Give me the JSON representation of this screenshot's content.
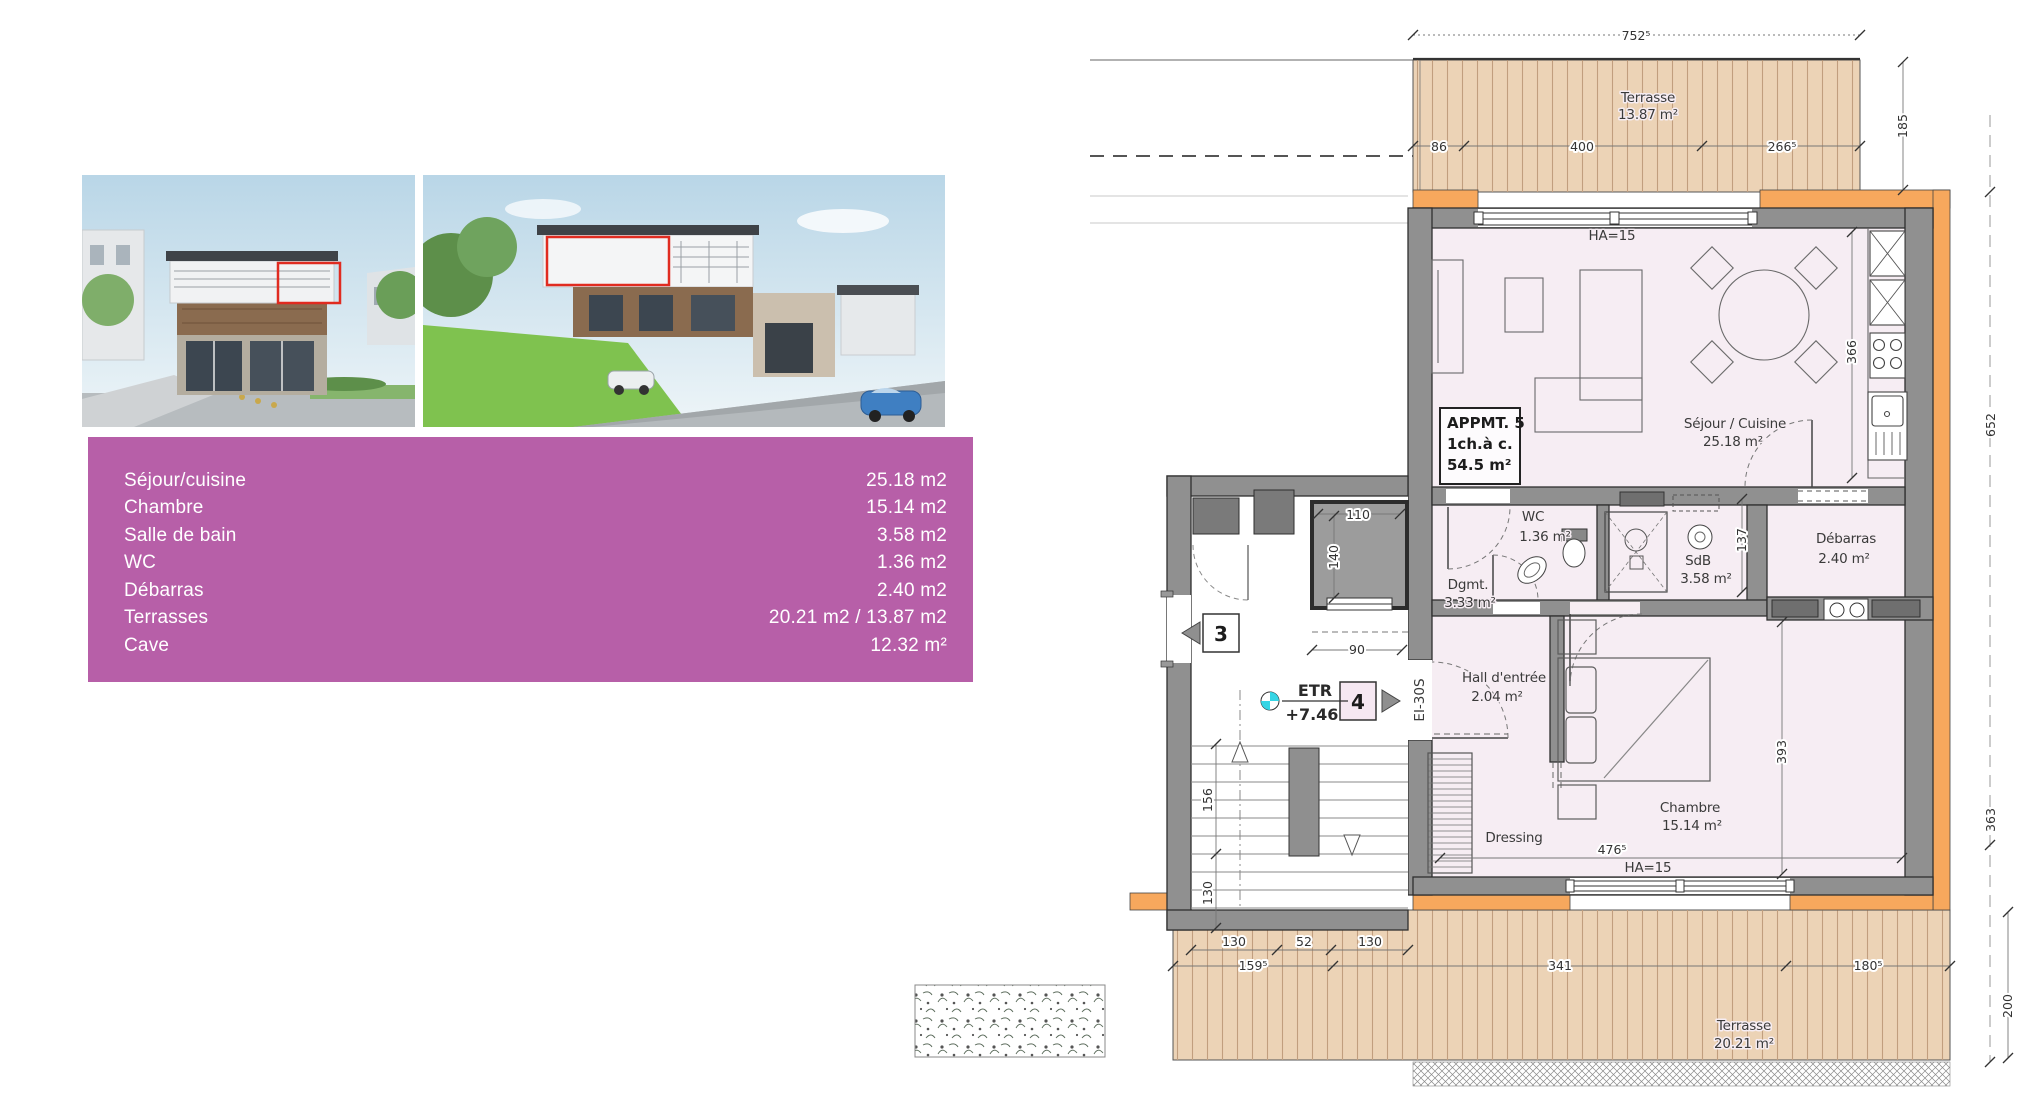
{
  "colors": {
    "accent_magenta": "#b75fa8",
    "highlight_red": "#e02b20",
    "insulation_orange": "#f7a85d",
    "deck_wood": "#ecd3b6",
    "interior_pink": "#f6edf3",
    "wall_gray": "#909090",
    "etr_cyan": "#35d5e5"
  },
  "table": {
    "rows": [
      {
        "label": "Séjour/cuisine",
        "value": "25.18 m2"
      },
      {
        "label": "Chambre",
        "value": "15.14 m2"
      },
      {
        "label": "Salle de bain",
        "value": "3.58 m2"
      },
      {
        "label": "WC",
        "value": "1.36 m2"
      },
      {
        "label": "Débarras",
        "value": "2.40 m2"
      },
      {
        "label": "Terrasses",
        "value": "20.21 m2 / 13.87 m2"
      },
      {
        "label": "Cave",
        "value": "12.32 m²"
      }
    ]
  },
  "plan": {
    "apartment_box": {
      "line1": "APPMT. 5",
      "line2": "1ch.à c.",
      "line3": "54.5 m²"
    },
    "rooms": {
      "terrace_top": {
        "name": "Terrasse",
        "area": "13.87 m²"
      },
      "sejour": {
        "name": "Séjour / Cuisine",
        "area": "25.18 m²"
      },
      "wc": {
        "name": "WC",
        "area": "1.36 m²"
      },
      "sdb": {
        "name": "SdB",
        "area": "3.58 m²"
      },
      "debarras": {
        "name": "Débarras",
        "area": "2.40 m²"
      },
      "dgmt": {
        "name": "Dgmt.",
        "area": "3.33 m²"
      },
      "hall": {
        "name": "Hall d'entrée",
        "area": "2.04 m²"
      },
      "dressing": {
        "name": "Dressing"
      },
      "chambre": {
        "name": "Chambre",
        "area": "15.14 m²"
      },
      "terrace_bottom": {
        "name": "Terrasse",
        "area": "20.21 m²"
      }
    },
    "dimensions": {
      "top_total": "752⁵",
      "top_a": "86",
      "top_b": "400",
      "top_c": "266⁵",
      "right_terrace": "185",
      "kitchen_depth": "366",
      "right_total": "652",
      "bath_width": "137",
      "elev_w": "110",
      "elev_h": "140",
      "elev_door": "90",
      "stair_a": "156",
      "stair_b": "130",
      "stairs_w1": "130",
      "stairs_w2": "52",
      "stairs_w3": "130",
      "chambre_h": "393",
      "chambre_w": "476⁵",
      "right_lower": "363",
      "bot_a": "159⁵",
      "bot_b": "341",
      "bot_c": "180⁵",
      "bot_right": "200"
    },
    "annotations": {
      "ha_top": "HA=15",
      "ha_bottom": "HA=15",
      "etr": "ETR",
      "level": "+7.46",
      "badge3": "3",
      "badge4": "4",
      "door_rating": "EI-30S"
    }
  }
}
